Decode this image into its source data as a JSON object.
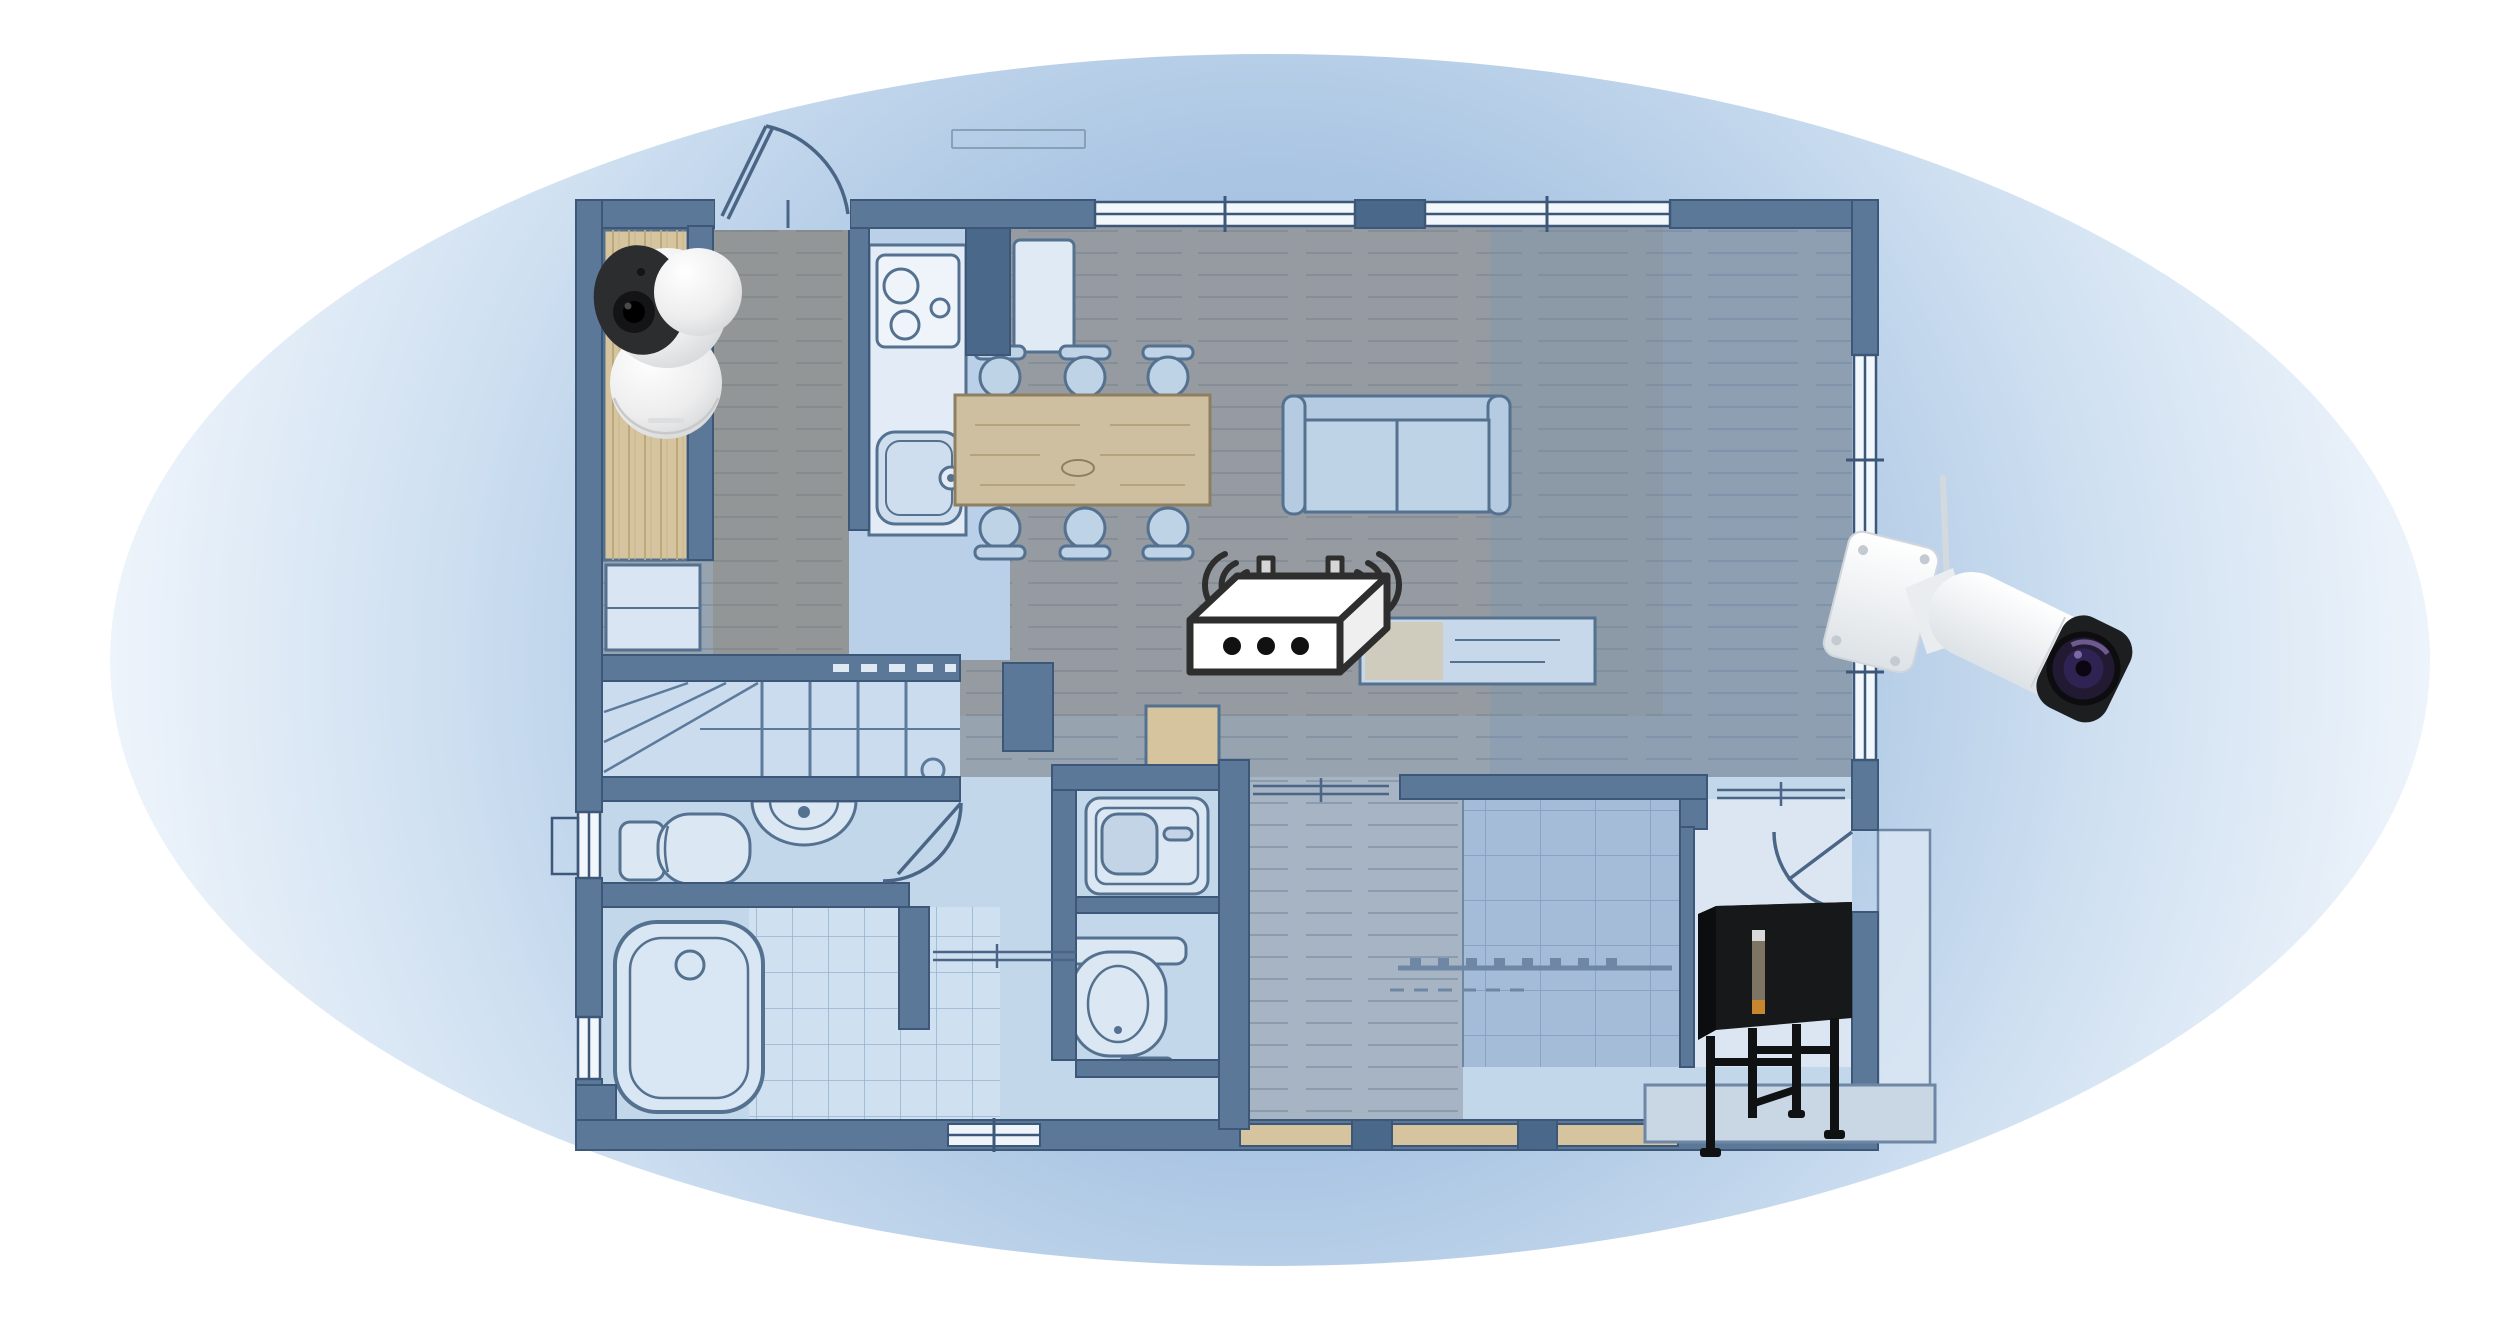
{
  "illustration": {
    "kind": "wifi-coverage-floorplan-diagram",
    "coverage_shape": "ellipse",
    "devices": [
      {
        "id": "indoor_camera",
        "icon": "indoor-pan-tilt-camera-icon",
        "location": "top-left-room"
      },
      {
        "id": "wifi_router",
        "icon": "wifi-router-icon",
        "location": "center-of-living-area",
        "antennas": 2,
        "front_dots": 3,
        "signal_arcs_per_side": 3
      },
      {
        "id": "outdoor_camera",
        "icon": "outdoor-bullet-camera-icon",
        "location": "right-exterior-wall"
      },
      {
        "id": "delivery_box",
        "icon": "black-stand-box-icon",
        "location": "bottom-right-entry-porch"
      }
    ],
    "floorplan_features": [
      "entrance-door-arc",
      "closet",
      "shoe-cabinet",
      "kitchen-counter",
      "stove-burners",
      "kitchen-sink",
      "refrigerator",
      "dining-table",
      "dining-chairs",
      "sofa",
      "coffee-table",
      "stairs",
      "toilet",
      "vanity-basin",
      "bathtub",
      "tiled-shower",
      "washbasin-unit",
      "second-toilet",
      "tatami-room-grid",
      "closet-rail",
      "genkan-door-arc",
      "porch-step",
      "windows"
    ]
  },
  "colors": {
    "page_bg": "#ffffff",
    "coverage_center": "#9cbadd",
    "coverage_mid": "#aac5e3",
    "coverage_soft": "#cfe0f1",
    "coverage_edge": "#eef4fb",
    "wall": "#5b7899",
    "wall_dark": "#4a688a",
    "wall_stroke": "#3d5778",
    "floor_wood": "#98a3b0",
    "wood_tint": "#8a7b63",
    "floor_kitchen": "#b9d0e8",
    "floor_tile": "#c3d7ea",
    "floor_hall": "#a6b4c3",
    "tatami": "#a4bcd7",
    "genkan": "#dbe6f2",
    "fixture_fill": "#dbe7f3",
    "fixture_stroke": "#54718f",
    "tan_wood": "#d5c49e",
    "furniture_blue": "#bfd3e7",
    "table_wood": "#cdbf9f",
    "router_ink": "#2e2e2e",
    "antenna_gray": "#cfcfcf",
    "camera_white": "#f2f3f4",
    "lens_purple": "#2e2352",
    "box_black": "#17181a",
    "panel_tan": "#7d7463",
    "panel_orange": "#c8862f"
  }
}
